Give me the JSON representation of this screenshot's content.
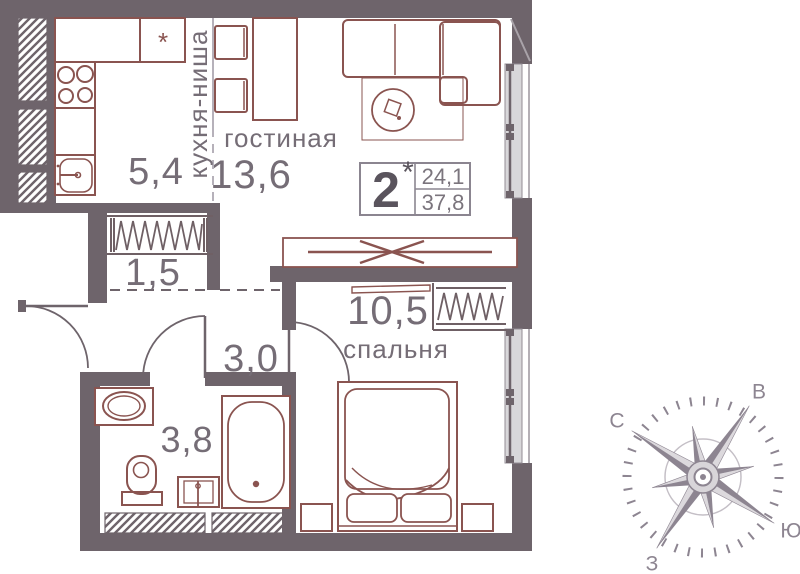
{
  "plan_info": {
    "rooms_count": "2",
    "rooms_star": "*",
    "area_living": "24,1",
    "area_total": "37,8"
  },
  "rooms": {
    "kitchen_niche": {
      "name": "кухня-ниша",
      "area": "5,4"
    },
    "living": {
      "name": "гостиная",
      "area": "13,6"
    },
    "wardrobe": {
      "area": "1,5"
    },
    "hallway": {
      "area": "3,0"
    },
    "bedroom": {
      "name": "спальня",
      "area": "10,5"
    },
    "bathroom": {
      "area": "3,8"
    }
  },
  "symbols": {
    "fridge": "*"
  },
  "compass": {
    "north": "С",
    "east": "В",
    "south": "Ю",
    "west": "З"
  },
  "colors": {
    "wall": "#6e646b",
    "furniture": "#8a5450",
    "glass": "#d8d7da",
    "text": "#756d76",
    "compass": "#8d8591"
  }
}
